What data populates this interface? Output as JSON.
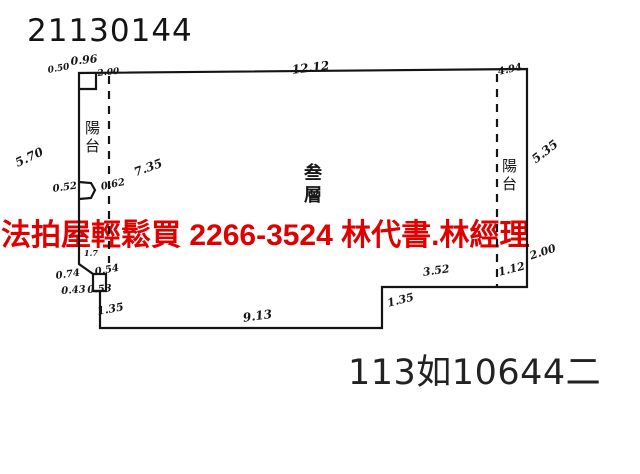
{
  "header": {
    "doc_number": "21130144"
  },
  "footer": {
    "case_number": "113如10644二"
  },
  "overlay": {
    "text": "法拍屋輕鬆買  2266-3524  林代書.林經理",
    "color": "#e00000"
  },
  "floor_plan": {
    "room_label": "叁層",
    "balcony_left_label": "陽台",
    "balcony_right_label": "陽台",
    "line_color": "#141414",
    "dimensions": [
      {
        "label": "0.96",
        "x": 70,
        "y": 55,
        "rot": -6,
        "size": 11
      },
      {
        "label": "0.50",
        "x": 47,
        "y": 66,
        "rot": -10,
        "size": 9
      },
      {
        "label": "2.00",
        "x": 97,
        "y": 69,
        "rot": -6,
        "size": 9
      },
      {
        "label": "12.12",
        "x": 291,
        "y": 63,
        "rot": -7,
        "size": 12
      },
      {
        "label": "4.94",
        "x": 497,
        "y": 67,
        "rot": -12,
        "size": 10
      },
      {
        "label": "5.35",
        "x": 529,
        "y": 155,
        "rot": -38,
        "size": 12
      },
      {
        "label": "5.70",
        "x": 13,
        "y": 157,
        "rot": -25,
        "size": 12
      },
      {
        "label": "7.35",
        "x": 132,
        "y": 166,
        "rot": -20,
        "size": 12
      },
      {
        "label": "0.52",
        "x": 52,
        "y": 184,
        "rot": -8,
        "size": 10
      },
      {
        "label": "0.62",
        "x": 100,
        "y": 182,
        "rot": -12,
        "size": 10
      },
      {
        "label": "1.7",
        "x": 84,
        "y": 248,
        "rot": 0,
        "size": 8
      },
      {
        "label": "0.74",
        "x": 55,
        "y": 271,
        "rot": -8,
        "size": 10
      },
      {
        "label": "0.54",
        "x": 94,
        "y": 267,
        "rot": -10,
        "size": 10
      },
      {
        "label": "0.43",
        "x": 61,
        "y": 286,
        "rot": -4,
        "size": 10
      },
      {
        "label": "0.53",
        "x": 87,
        "y": 285,
        "rot": -4,
        "size": 10
      },
      {
        "label": "1.35",
        "x": 96,
        "y": 305,
        "rot": -10,
        "size": 11
      },
      {
        "label": "9.13",
        "x": 242,
        "y": 311,
        "rot": -8,
        "size": 12
      },
      {
        "label": "1.35",
        "x": 386,
        "y": 297,
        "rot": -14,
        "size": 11
      },
      {
        "label": "3.52",
        "x": 422,
        "y": 266,
        "rot": -8,
        "size": 11
      },
      {
        "label": "1.12",
        "x": 497,
        "y": 266,
        "rot": -14,
        "size": 11
      },
      {
        "label": "2.00",
        "x": 528,
        "y": 250,
        "rot": -18,
        "size": 11
      }
    ]
  }
}
